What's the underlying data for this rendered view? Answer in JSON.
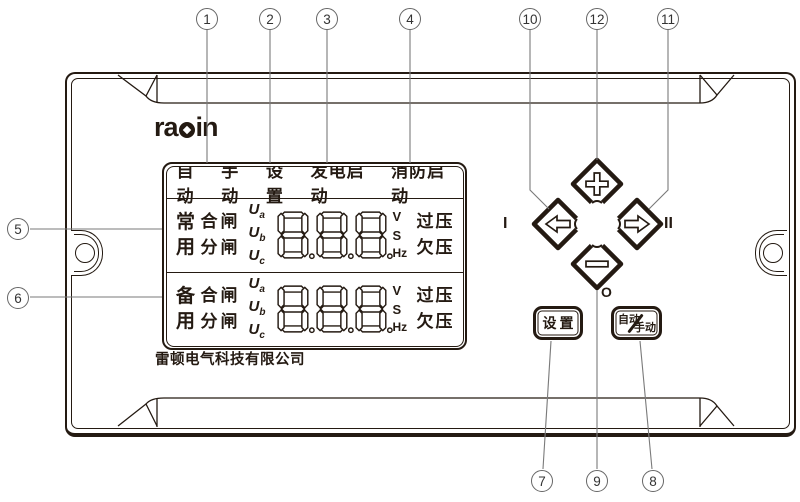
{
  "colors": {
    "ink": "#241a12",
    "callout_line": "#7a7a7a"
  },
  "logo": {
    "prefix": "ra",
    "suffix": "in"
  },
  "company_name": "雷顿电气科技有限公司",
  "lcd": {
    "mode_labels": [
      "自动",
      "手动",
      "设置",
      "发电启动",
      "消防启动"
    ],
    "rows": [
      {
        "source_line1": "常",
        "source_line2": "用",
        "close_label": "合闸",
        "open_label": "分闸",
        "phase_labels": [
          {
            "base": "U",
            "sub": "a"
          },
          {
            "base": "U",
            "sub": "b"
          },
          {
            "base": "U",
            "sub": "c"
          }
        ],
        "digits": [
          "8",
          "8",
          "8"
        ],
        "unit_top": "V",
        "unit_mid": "S",
        "unit_bottom": "Hz",
        "status_top": "过压",
        "status_bottom": "欠压"
      },
      {
        "source_line1": "备",
        "source_line2": "用",
        "close_label": "合闸",
        "open_label": "分闸",
        "phase_labels": [
          {
            "base": "U",
            "sub": "a"
          },
          {
            "base": "U",
            "sub": "b"
          },
          {
            "base": "U",
            "sub": "c"
          }
        ],
        "digits": [
          "8",
          "8",
          "8"
        ],
        "unit_top": "V",
        "unit_mid": "S",
        "unit_bottom": "Hz",
        "status_top": "过压",
        "status_bottom": "欠压"
      }
    ]
  },
  "keypad": {
    "left_side_label": "I",
    "right_side_label": "II",
    "below_label": "O"
  },
  "buttons": {
    "set_label": "设置",
    "auto_label": "自动",
    "manual_label": "手动"
  },
  "callouts": [
    {
      "label": "1",
      "cx": 207,
      "cy": 19
    },
    {
      "label": "2",
      "cx": 270,
      "cy": 19
    },
    {
      "label": "3",
      "cx": 327,
      "cy": 19
    },
    {
      "label": "4",
      "cx": 410,
      "cy": 19
    },
    {
      "label": "10",
      "cx": 530,
      "cy": 19
    },
    {
      "label": "12",
      "cx": 597,
      "cy": 19
    },
    {
      "label": "11",
      "cx": 668,
      "cy": 19
    },
    {
      "label": "5",
      "cx": 18,
      "cy": 229
    },
    {
      "label": "6",
      "cx": 18,
      "cy": 298
    },
    {
      "label": "7",
      "cx": 542,
      "cy": 481
    },
    {
      "label": "9",
      "cx": 597,
      "cy": 481
    },
    {
      "label": "8",
      "cx": 653,
      "cy": 481
    }
  ]
}
